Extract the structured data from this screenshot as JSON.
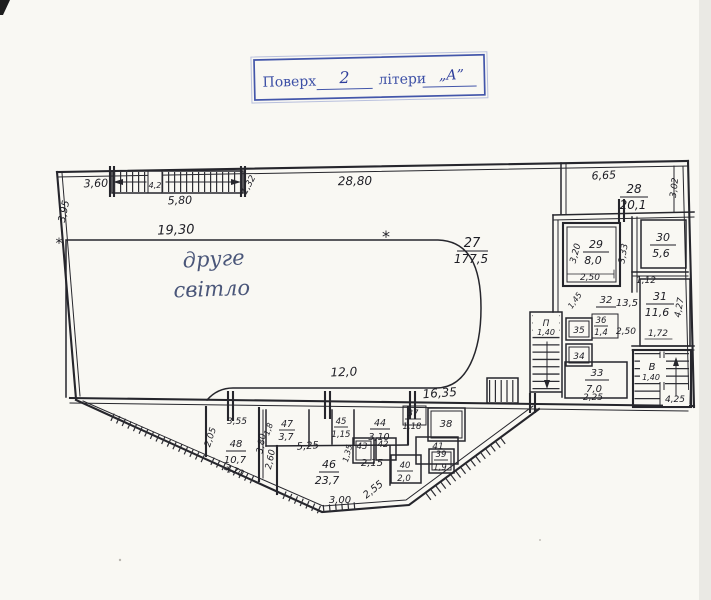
{
  "stamp": {
    "floor_label": "Поверх",
    "floor_value": "2",
    "letters_label": "літери",
    "letters_value": "„А”"
  },
  "hall": {
    "number": "27",
    "area": "177,5",
    "note_line1": "друге",
    "note_line2": "світло",
    "asterisk": "*"
  },
  "rooms": {
    "r28": {
      "num": "28",
      "area": "20,1"
    },
    "r29": {
      "num": "29",
      "area": "8,0"
    },
    "r30": {
      "num": "30",
      "area": "5,6"
    },
    "r31": {
      "num": "31",
      "area": "11,6"
    },
    "r32": {
      "num": "32",
      "area": "13,5"
    },
    "r33": {
      "num": "33",
      "area": "7,0"
    },
    "r34": {
      "num": "34"
    },
    "r35": {
      "num": "35"
    },
    "r36": {
      "num": "36",
      "area": "1,4"
    },
    "r37": {
      "num": "37",
      "area": "1,18"
    },
    "r38": {
      "num": "38"
    },
    "r39": {
      "num": "39",
      "area": "1,9"
    },
    "r40": {
      "num": "40",
      "area": "2,0"
    },
    "r41": {
      "num": "41"
    },
    "r42": {
      "num": "42"
    },
    "r43": {
      "num": "43"
    },
    "r44": {
      "num": "44",
      "area": "3,10"
    },
    "r45": {
      "num": "45",
      "area": "1,15"
    },
    "r46": {
      "num": "46",
      "area": "23,7"
    },
    "r47": {
      "num": "47",
      "area": "3,7"
    },
    "r48": {
      "num": "48",
      "area": "10,7"
    }
  },
  "dims": {
    "top_left_width": "3,60",
    "left_height": "3,95",
    "stair_strip_length": "5,80",
    "stair_strip_mid": "4,2",
    "stair_strip_diag": "1,32",
    "top_total": "28,80",
    "hall_top": "19,30",
    "hall_bottom": "12,0",
    "bottom_span": "16,35",
    "r28_width": "6,65",
    "r28_depth": "3,02",
    "r29_height": "3,20",
    "r29_width": "2,50",
    "below_r29": "1,45",
    "corridor_height": "3,33",
    "below_corridor": "1,12",
    "r31_height": "4,27",
    "r31_width": "1,72",
    "r32_width": "2,50",
    "r33_width": "2,25",
    "r48_left": "2,05",
    "r48_top": "3,55",
    "r48_right": "3,80",
    "r48_bottom": "3,70",
    "r47_left": "1,8",
    "corridor_width": "5,25",
    "r46_left": "2,60",
    "r46_mid": "2,15",
    "r43_left": "1,35",
    "r46_diag": "2,55",
    "bottom_width": "3,00"
  },
  "stairs": {
    "left_label": "П",
    "left_width": "1,40",
    "right_label": "В",
    "right_width": "1,40",
    "right_height": "4,25"
  }
}
